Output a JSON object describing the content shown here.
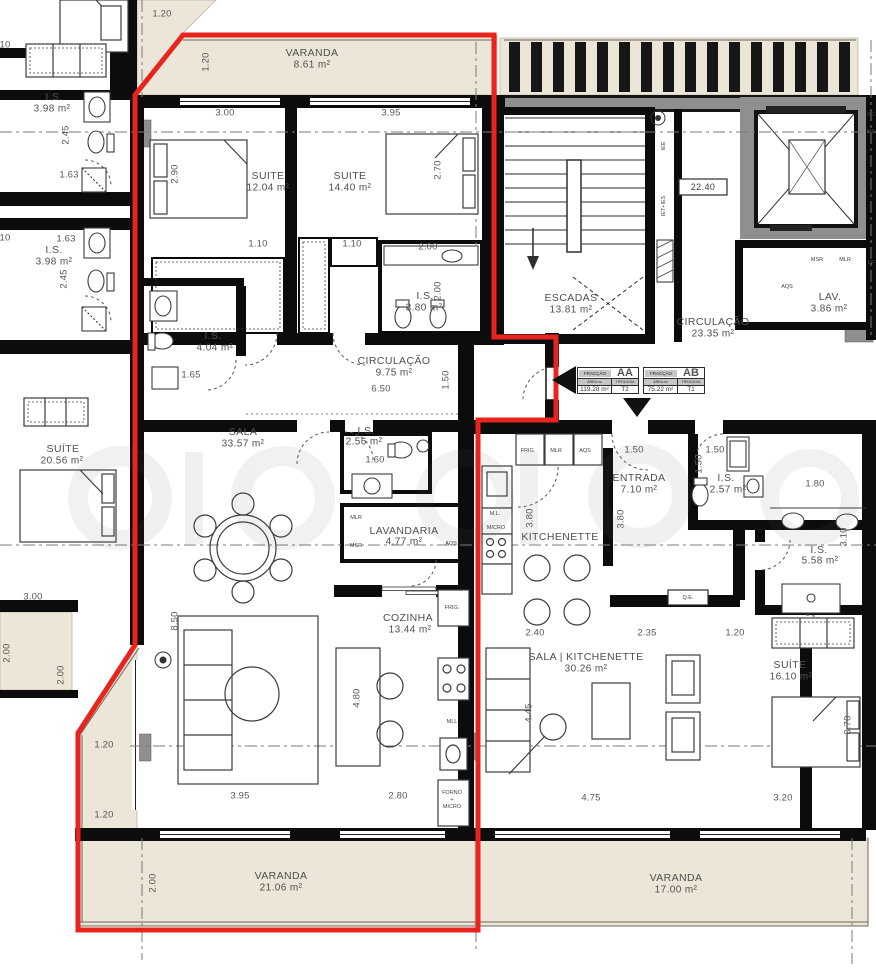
{
  "colors": {
    "fraction_outline_red": "#e8241f",
    "balcony_fill": "#ece6d8",
    "wall_black": "#0c0c0c",
    "core_gray": "#8f8f8f",
    "label_text": "#4f4f4f"
  },
  "rooms": {
    "varanda_top": {
      "name": "VARANDA",
      "area": "8.61 m²"
    },
    "suite1": {
      "name": "SUITE",
      "area": "12.04 m²"
    },
    "suite2": {
      "name": "SUITE",
      "area": "14.40 m²"
    },
    "is_l1": {
      "name": "I.S.",
      "area": "3.98 m²"
    },
    "is_l2": {
      "name": "I.S.",
      "area": "3.98 m²"
    },
    "is_404": {
      "name": "I.S.",
      "area": "4.04 m²"
    },
    "is_380": {
      "name": "I.S.",
      "area": "3.80 m²"
    },
    "circ_aa": {
      "name": "CIRCULAÇÃO",
      "area": "9.75 m²"
    },
    "escadas": {
      "name": "ESCADAS",
      "area": "13.81 m²"
    },
    "circ_common": {
      "name": "CIRCULAÇÃO",
      "area": "23.35 m²"
    },
    "lav": {
      "name": "LAV.",
      "area": "3.86 m²"
    },
    "suite_left": {
      "name": "SUÍTE",
      "area": "20.56 m²"
    },
    "sala": {
      "name": "SALA",
      "area": "33.57 m²"
    },
    "is_256": {
      "name": "I.S.",
      "area": "2.56 m²"
    },
    "lavandaria": {
      "name": "LAVANDARIA",
      "area": "4.77 m²"
    },
    "cozinha": {
      "name": "COZINHA",
      "area": "13.44 m²"
    },
    "kitchenette": {
      "name": "KITCHENETTE",
      "area": ""
    },
    "entrada": {
      "name": "ENTRADA",
      "area": "7.10 m²"
    },
    "is_257": {
      "name": "I.S.",
      "area": "2.57 m²"
    },
    "is_558": {
      "name": "I.S.",
      "area": "5.58 m²"
    },
    "sala_kit": {
      "name": "SALA | KITCHENETTE",
      "area": "30.26 m²"
    },
    "suite_ab": {
      "name": "SUÍTE",
      "area": "16.10 m²"
    },
    "varanda_bl": {
      "name": "VARANDA",
      "area": "21.06 m²"
    },
    "varanda_br": {
      "name": "VARANDA",
      "area": "17.00 m²"
    }
  },
  "dims": {
    "d01": "1.20",
    "d02": "1.20",
    "d03": "3.00",
    "d04": "3.95",
    "d05": "2.90",
    "d06": "2.70",
    "d07": "1.10",
    "d08": "1.10",
    "d09": "2.00",
    "d10": "2.00",
    "d11": "2.45",
    "d12": "1.63",
    "d13": "1.63",
    "d14": "2.45",
    "d15": "1.65",
    "d16": "6.50",
    "d17": "1.50",
    "d18": "3.00",
    "d19": "8.50",
    "d20": "10",
    "d21": "10",
    "d22": "1.50",
    "d23": "1.50",
    "d24": "1.50",
    "d25": "3.80",
    "d26": "3.80",
    "d27": "1.80",
    "d28": "3.10",
    "d29": "1.60",
    "d30": "4.80",
    "d31": "2.80",
    "d32": "3.95",
    "d33": "2.40",
    "d34": "2.35",
    "d35": "1.20",
    "d36": "4.45",
    "d37": "4.75",
    "d38": "3.20",
    "d39": "3.70",
    "d40": "2.00",
    "d41": "1.20",
    "d42": "1.20",
    "d43": "2.00",
    "d44": "2.00"
  },
  "labels": {
    "msr_top": "MSR",
    "mlr_top": "MLR",
    "aqs_top": "AQS",
    "iee": "IEE",
    "iet_ies": "IET+IES",
    "box_2240": "22.40",
    "frig_coz": "FRIG.",
    "mll": "MLL",
    "forno_coz": "FORNO",
    "plus_coz": "+",
    "micro_coz": "MICRO",
    "frig_kit": "FRIG.",
    "mlr_kit": "MLR",
    "aqs_kit": "AQS",
    "ml_kit": "M.L.",
    "micro_kit": "MICRO",
    "mlr_lav": "MLR",
    "msr_lav": "MSR",
    "aqs_lav": "AQS",
    "qe": "Q.E.",
    "edge_fd": "FD",
    "edge_me": "ME",
    "edge_ef": "EF"
  },
  "fractions": {
    "header_label": "FRACÇÃO",
    "area_label": "ÁREA m²",
    "type_label": "TIPOLOGIA",
    "aa": {
      "code": "AA",
      "area": "119.28 m²",
      "type": "T2"
    },
    "ab": {
      "code": "AB",
      "area": "75.22 m²",
      "type": "T1"
    }
  }
}
